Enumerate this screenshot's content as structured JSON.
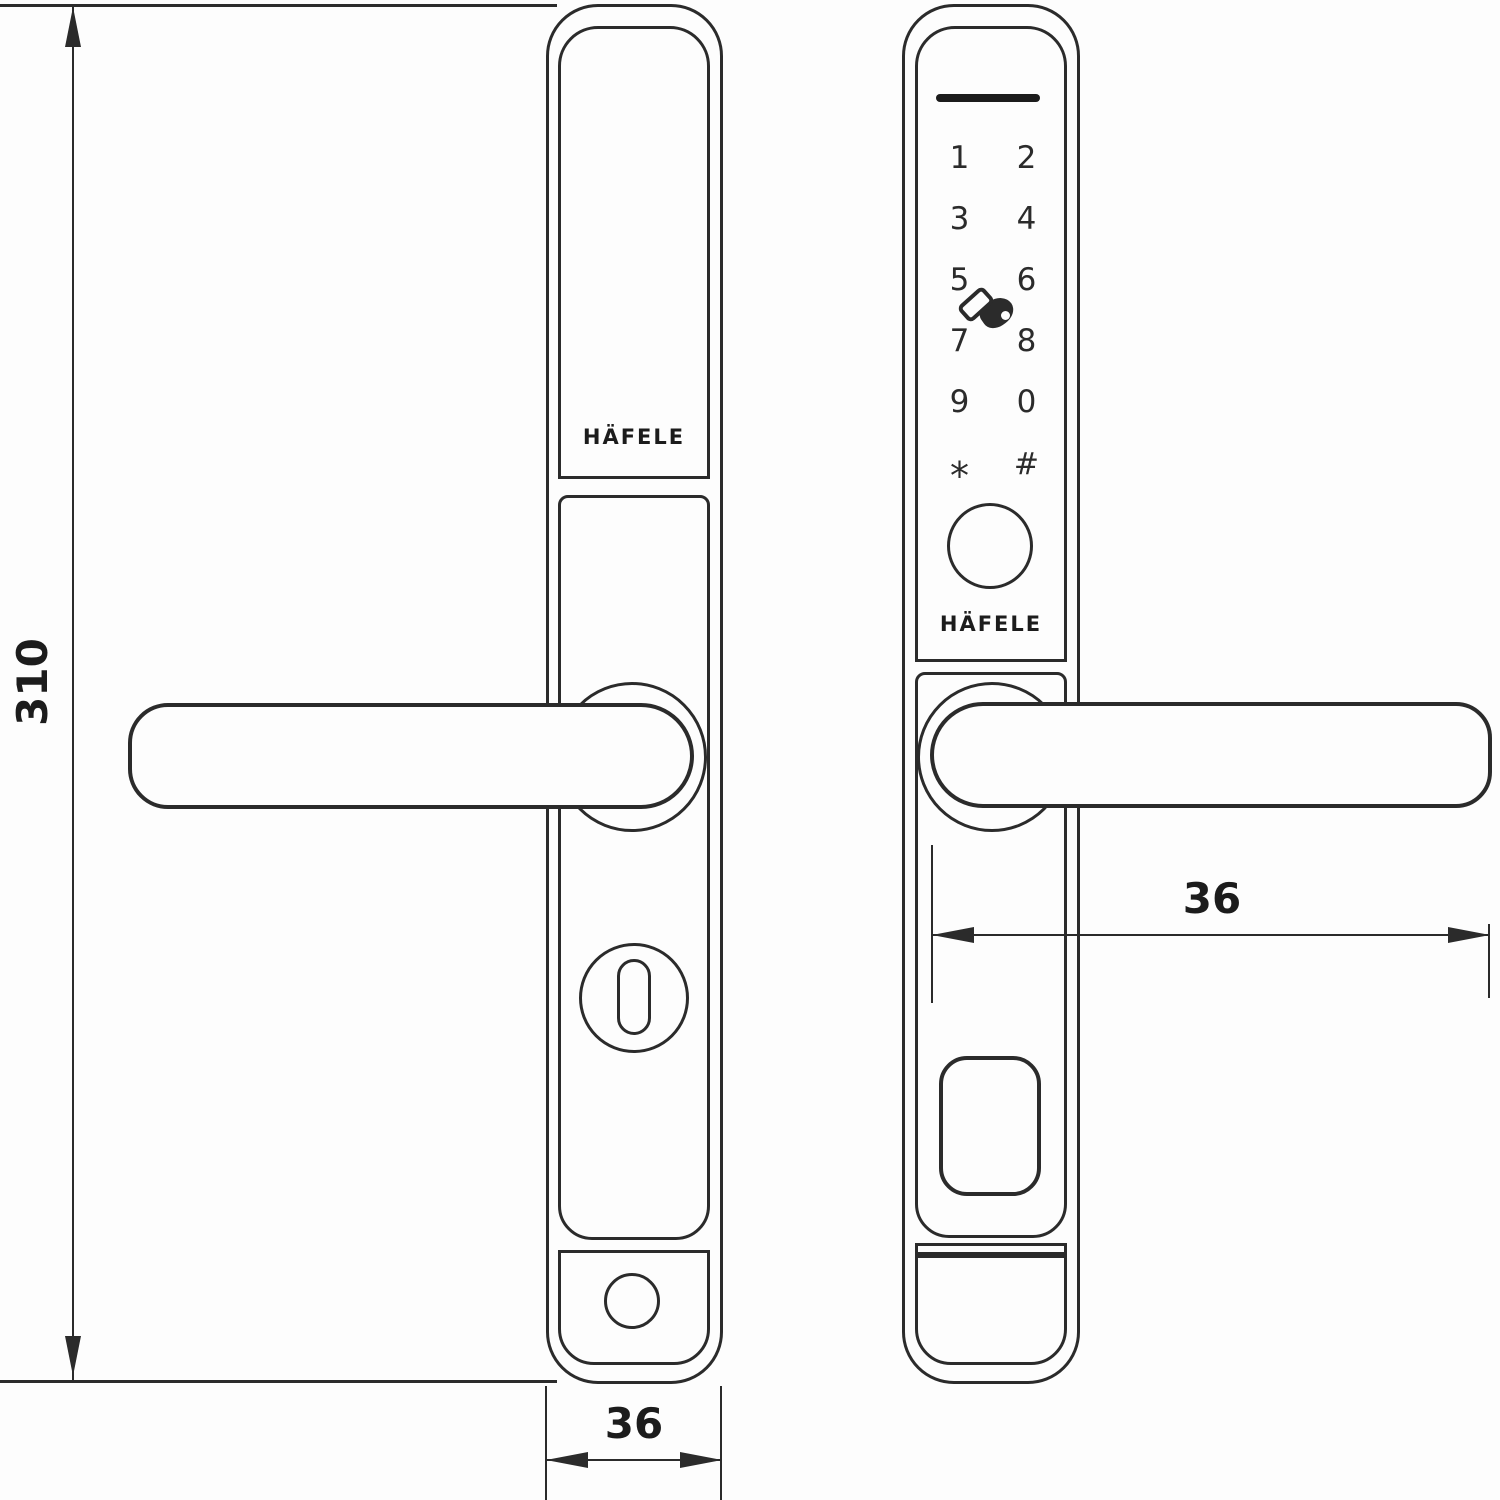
{
  "colors": {
    "background": "#fdfdfd",
    "line": "#2b2b2b",
    "indicator_bar": "#1c1c1c",
    "text": "#1c1c1c"
  },
  "dimensions": {
    "overall_height_mm": "310",
    "left_plate_width_mm": "36",
    "right_plate_width_mm": "36"
  },
  "left_plate": {
    "brand": "HÄFELE",
    "icons": {
      "keyhole": "keyhole-icon",
      "screw_hole": "screw-hole-icon",
      "handle": "lever-handle"
    }
  },
  "right_plate": {
    "brand": "HÄFELE",
    "keypad_keys": [
      "1",
      "2",
      "3",
      "4",
      "5",
      "6",
      "7",
      "8",
      "9",
      "0",
      "*",
      "#"
    ],
    "icons": {
      "indicator_bar": "status-indicator-bar",
      "card_tap": "card-tap-icon",
      "fingerprint": "fingerprint-sensor-icon",
      "battery_cover": "battery-cover",
      "handle": "lever-handle"
    }
  }
}
